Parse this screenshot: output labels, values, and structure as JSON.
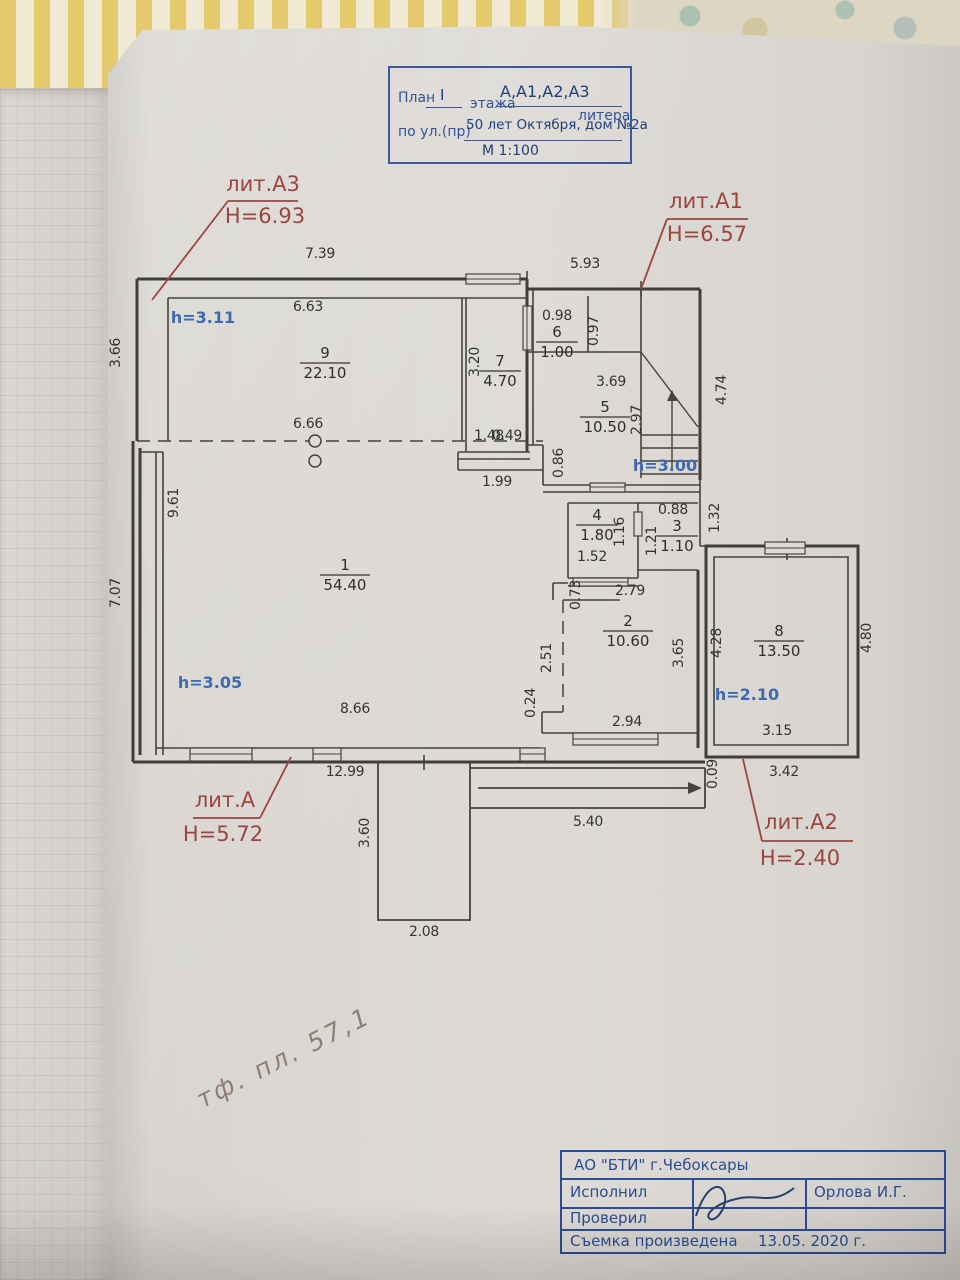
{
  "document": {
    "title_block": {
      "plan_label": "План",
      "floor_value": "I",
      "floor_label": "этажа",
      "litera_value": "А,А1,А2,А3",
      "litera_label": "литера",
      "street_label": "по ул.(пр)",
      "street_value": "50 лет Октября, дом №2а",
      "scale": "М 1:100"
    },
    "plan": {
      "dimensions": [
        {
          "t": "7.39",
          "x": 320,
          "y": 258
        },
        {
          "t": "5.93",
          "x": 585,
          "y": 268
        },
        {
          "t": "6.63",
          "x": 308,
          "y": 311
        },
        {
          "t": "3.20",
          "x": 479,
          "y": 362,
          "r": -90
        },
        {
          "t": "6.66",
          "x": 308,
          "y": 428
        },
        {
          "t": "1.48",
          "x": 489,
          "y": 440
        },
        {
          "t": "0.49",
          "x": 507,
          "y": 440
        },
        {
          "t": "1.99",
          "x": 497,
          "y": 486
        },
        {
          "t": "0.86",
          "x": 563,
          "y": 463,
          "r": -90
        },
        {
          "t": "0.98",
          "x": 557,
          "y": 320
        },
        {
          "t": "0.97",
          "x": 598,
          "y": 331,
          "r": -90
        },
        {
          "t": "3.69",
          "x": 611,
          "y": 386
        },
        {
          "t": "2.97",
          "x": 641,
          "y": 420,
          "r": -90
        },
        {
          "t": "4.74",
          "x": 726,
          "y": 390,
          "r": -90
        },
        {
          "t": "1.32",
          "x": 719,
          "y": 518,
          "r": -90
        },
        {
          "t": "0.88",
          "x": 673,
          "y": 514
        },
        {
          "t": "1.21",
          "x": 656,
          "y": 541,
          "r": -90
        },
        {
          "t": "1.16",
          "x": 624,
          "y": 532,
          "r": -90
        },
        {
          "t": "1.52",
          "x": 592,
          "y": 561
        },
        {
          "t": "2.79",
          "x": 630,
          "y": 595
        },
        {
          "t": "0.73",
          "x": 580,
          "y": 595,
          "r": -90
        },
        {
          "t": "9.61",
          "x": 178,
          "y": 503,
          "r": -90
        },
        {
          "t": "7.07",
          "x": 120,
          "y": 593,
          "r": -90
        },
        {
          "t": "3.66",
          "x": 120,
          "y": 353,
          "r": -90
        },
        {
          "t": "8.66",
          "x": 355,
          "y": 713
        },
        {
          "t": "2.51",
          "x": 551,
          "y": 658,
          "r": -90
        },
        {
          "t": "0.24",
          "x": 535,
          "y": 703,
          "r": -90
        },
        {
          "t": "3.65",
          "x": 683,
          "y": 653,
          "r": -90
        },
        {
          "t": "2.94",
          "x": 627,
          "y": 726
        },
        {
          "t": "4.28",
          "x": 721,
          "y": 643,
          "r": -90
        },
        {
          "t": "4.80",
          "x": 871,
          "y": 638,
          "r": -90
        },
        {
          "t": "3.15",
          "x": 777,
          "y": 735
        },
        {
          "t": "3.42",
          "x": 784,
          "y": 776
        },
        {
          "t": "0.09",
          "x": 717,
          "y": 774,
          "r": -90
        },
        {
          "t": "12.99",
          "x": 345,
          "y": 776
        },
        {
          "t": "3.60",
          "x": 369,
          "y": 833,
          "r": -90
        },
        {
          "t": "2.08",
          "x": 424,
          "y": 936
        },
        {
          "t": "5.40",
          "x": 588,
          "y": 826
        }
      ],
      "rooms": [
        {
          "n": "1",
          "a": "54.40",
          "x": 345,
          "y": 570
        },
        {
          "n": "2",
          "a": "10.60",
          "x": 628,
          "y": 626
        },
        {
          "n": "3",
          "a": "1.10",
          "x": 677,
          "y": 531
        },
        {
          "n": "4",
          "a": "1.80",
          "x": 597,
          "y": 520
        },
        {
          "n": "5",
          "a": "10.50",
          "x": 605,
          "y": 412
        },
        {
          "n": "6",
          "a": "1.00",
          "x": 557,
          "y": 337
        },
        {
          "n": "7",
          "a": "4.70",
          "x": 500,
          "y": 366
        },
        {
          "n": "8",
          "a": "13.50",
          "x": 779,
          "y": 636
        },
        {
          "n": "9",
          "a": "22.10",
          "x": 325,
          "y": 358
        }
      ],
      "heights": [
        {
          "t": "h=3.11",
          "x": 203,
          "y": 323
        },
        {
          "t": "h=3.00",
          "x": 665,
          "y": 471
        },
        {
          "t": "h=3.05",
          "x": 210,
          "y": 688
        },
        {
          "t": "h=2.10",
          "x": 747,
          "y": 700
        }
      ],
      "literas": [
        {
          "name": "лит.А3",
          "h": "Н=6.93",
          "x": 263,
          "y": 191,
          "ux1": 228,
          "ux2": 298,
          "uy": 201,
          "hx": 265,
          "hy": 223,
          "lx1": 228,
          "ly1": 201,
          "lx2": 152,
          "ly2": 300
        },
        {
          "name": "лит.А1",
          "h": "Н=6.57",
          "x": 706,
          "y": 208,
          "ux1": 667,
          "ux2": 748,
          "uy": 219,
          "hx": 707,
          "hy": 241,
          "lx1": 667,
          "ly1": 219,
          "lx2": 641,
          "ly2": 289
        },
        {
          "name": "лит.А",
          "h": "Н=5.72",
          "x": 225,
          "y": 807,
          "ux1": 193,
          "ux2": 260,
          "uy": 818,
          "hx": 223,
          "hy": 841,
          "lx1": 260,
          "ly1": 818,
          "lx2": 291,
          "ly2": 757
        },
        {
          "name": "лит.А2",
          "h": "Н=2.40",
          "x": 801,
          "y": 829,
          "ux1": 762,
          "ux2": 853,
          "uy": 841,
          "hx": 800,
          "hy": 865,
          "lx1": 762,
          "ly1": 841,
          "lx2": 743,
          "ly2": 759
        }
      ]
    },
    "stamp": {
      "org": "АО  \"БТИ\" г.Чебоксары",
      "row1_label": "Исполнил",
      "row1_value": "Орлова И.Г.",
      "row2_label": "Проверил",
      "footer_label": "Съемка произведена",
      "footer_value": "13.05.   2020 г."
    },
    "handwritten_note": "тф. пл. 57,1"
  }
}
